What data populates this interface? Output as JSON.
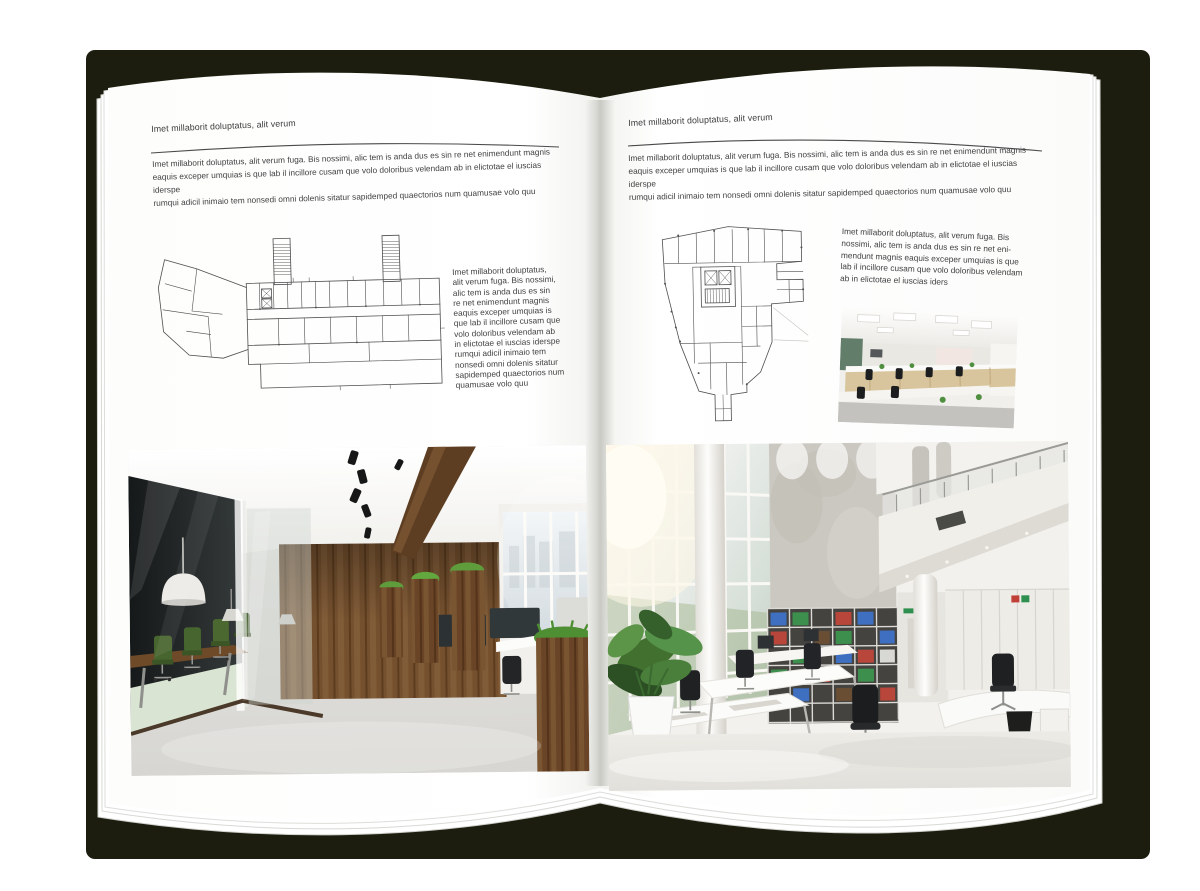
{
  "colors": {
    "cover": "#1c1d0e",
    "page": "#ffffff",
    "text": "#3c3c3c",
    "rule": "#4a4a4a",
    "plan-line": "#4e4e4e",
    "wood": "#74502e",
    "grass": "#5f9c3c",
    "chair-green": "#47652e",
    "binder-red": "#b8463a",
    "binder-green": "#3c8f4c",
    "binder-blue": "#3e6fc0"
  },
  "left_page": {
    "header": "Imet millaborit doluptatus, alit verum",
    "intro": "Imet millaborit doluptatus, alit verum fuga. Bis nossimi, alic tem is anda dus es sin re net enimendunt magnis\neaquis exceper umquias is que lab il incillore cusam que volo doloribus velendam ab in elictotae el iuscias iderspe\nrumqui adicil inimaio tem nonsedi omni dolenis sitatur sapidemped quaectorios num quamusae volo quu",
    "side_text": "Imet millaborit doluptatus,\nalit verum fuga. Bis nossimi,\nalic tem is anda dus es sin\nre net enimendunt magnis\neaquis exceper umquias is\nque lab il incillore cusam que\nvolo doloribus velendam ab\nin elictotae el iuscias iderspe\nrumqui adicil inimaio tem\nnonsedi omni dolenis sitatur\nsapidemped quaectorios num\nquamusae volo quu"
  },
  "right_page": {
    "header": "Imet millaborit doluptatus, alit verum",
    "intro": "Imet millaborit doluptatus, alit verum fuga. Bis nossimi, alic tem is anda dus es sin re net enimendunt magnis\neaquis exceper umquias is que lab il incillore cusam que volo doloribus velendam ab in elictotae el iuscias iderspe\nrumqui adicil inimaio tem nonsedi omni dolenis sitatur sapidemped quaectorios num quamusae volo quu",
    "side_text": "Imet millaborit doluptatus, alit verum fuga. Bis\nnossimi, alic tem is anda dus es sin re net eni-\nmendunt magnis eaquis exceper umquias is que\nlab il incillore cusam que volo doloribus velendam\nab in elictotae el iuscias iders"
  }
}
